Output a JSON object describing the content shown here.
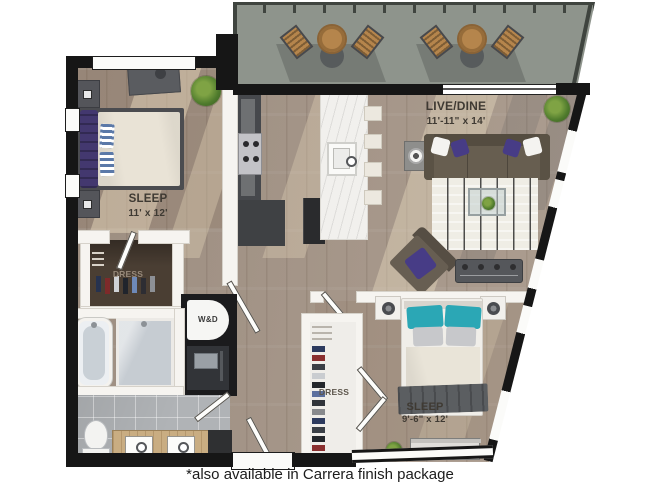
{
  "plan": {
    "rooms": {
      "sleep1": {
        "label": "SLEEP",
        "dims": "11' x 12'"
      },
      "live_dine": {
        "label": "LIVE/DINE",
        "dims": "11'-11\" x 14'"
      },
      "sleep2": {
        "label": "SLEEP",
        "dims": "9'-6\" x 12'"
      },
      "dress1": {
        "label": "DRESS"
      },
      "dress2": {
        "label": "DRESS"
      },
      "laundry": {
        "label": "W&D"
      }
    },
    "caption": "*also available in Carrera  finish package",
    "colors": {
      "exterior_wall": "#161616",
      "balcony_floor": "#8e948c",
      "wood_floor": "#a8988a",
      "accent_purple": "#473c86",
      "accent_teal": "#2ba7b5",
      "marble": "#f1f0ed"
    }
  }
}
